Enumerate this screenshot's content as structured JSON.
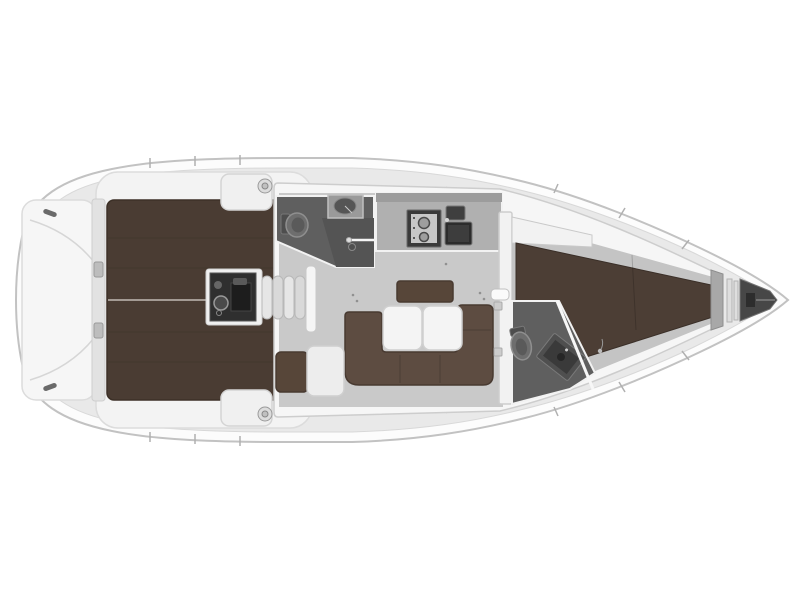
{
  "diagram": {
    "type": "yacht-interior-floorplan-top-view",
    "orientation": "bow-right",
    "visible_text": ""
  },
  "colors": {
    "background": "#ffffff",
    "hull_fill": "#fcfcfc",
    "deck": "#e9e9e9",
    "trunk_shell": "#f6f6f6",
    "cockpit_surround": "#f3f3f3",
    "platform": "#f6f6f6",
    "transom_wall": "#e2e2e2",
    "cockpit_floor": "#4a3c33",
    "saloon_floor": "#c9c9c9",
    "cabin_floor": "#c4c4c4",
    "head_floor": "#5f5f5f",
    "head_floor_dark": "#545454",
    "galley_counter": "#b0b0b0",
    "galley_back": "#9c9c9c",
    "stove": "#3a3a3a",
    "stove_panel": "#c7c7c7",
    "sink": "#2c2c2c",
    "sink_small": "#3f3f3f",
    "settee": "#5d4c41",
    "backrest": "#574639",
    "nav_seat": "#574639",
    "berth": "#4c3e35",
    "table": "#f4f4f4",
    "chart_table": "#ededed",
    "engine": "#2f2f2f",
    "steps_light": "#e6e6e6",
    "steps_dark": "#d9d9d9",
    "handrail": "#f5f5f5",
    "bench": "#f0f0f0",
    "winch": "#dcdcdc",
    "toilet": "#6e6e6e",
    "basin": "#555555",
    "basin_top": "#9a9a9a",
    "console": "#4f4f4f",
    "bow_bulkhead": "#a8a8a8",
    "anchor_locker": "#474747",
    "metal": "#bdbdbd",
    "shelf": "#f2f2f2",
    "bulkhead": "#f2f2f2"
  },
  "features": [
    {
      "id": "swim-platform"
    },
    {
      "id": "transom-wall"
    },
    {
      "id": "stern-cleats"
    },
    {
      "id": "cockpit"
    },
    {
      "id": "cockpit-benches"
    },
    {
      "id": "winches"
    },
    {
      "id": "engine-compartment"
    },
    {
      "id": "companionway-steps"
    },
    {
      "id": "aft-head-toilet-shower"
    },
    {
      "id": "galley-stove-sink"
    },
    {
      "id": "saloon-u-settee"
    },
    {
      "id": "saloon-folding-table"
    },
    {
      "id": "nav-station"
    },
    {
      "id": "forward-bulkhead-door"
    },
    {
      "id": "forward-head"
    },
    {
      "id": "v-berth"
    },
    {
      "id": "anchor-locker"
    }
  ]
}
